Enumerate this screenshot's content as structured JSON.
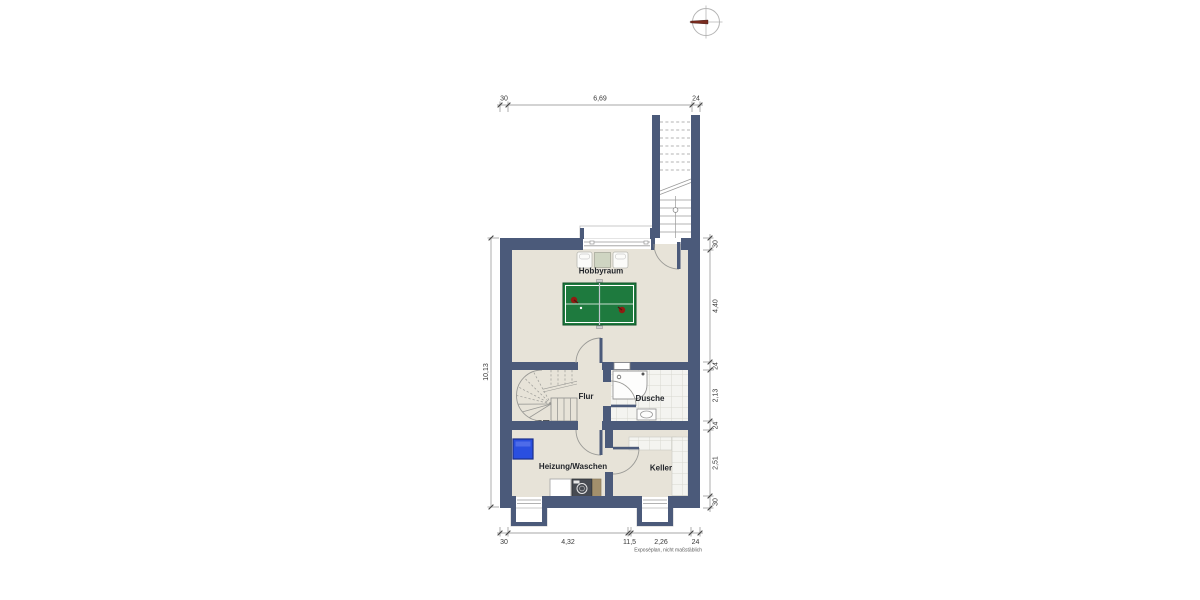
{
  "plan": {
    "title": "Kellergeschoss Grundriss",
    "rooms": {
      "hobbyraum": "Hobbyraum",
      "flur": "Flur",
      "dusche": "Dusche",
      "heizung_waschen": "Heizung/Waschen",
      "keller": "Keller"
    },
    "dimensions": {
      "top": {
        "wall_left": "30",
        "span": "6,69",
        "stair": "24"
      },
      "left": {
        "total": "10,13"
      },
      "right": {
        "wall_top": "30",
        "hobbyraum": "4,40",
        "wall_a": "24",
        "dusche": "2,13",
        "wall_b": "24",
        "keller": "2,51",
        "wall_bottom": "30"
      },
      "bottom": {
        "wall_left": "30",
        "heizung": "4,32",
        "wall_mid": "11,5",
        "keller": "2,26",
        "wall_right": "24"
      }
    },
    "disclaimer": "Exposéplan, nicht maßstäblich",
    "icons": {
      "compass": "compass-north-icon",
      "paddle": "table-tennis-paddle-icon"
    },
    "colors": {
      "wall": "#4b5a7a",
      "floor": "#e7e3d8",
      "tile": "#f4f4f0",
      "tile_line": "#d8d8d0",
      "table_green": "#1e7a3e",
      "boiler_blue": "#2a4fe0",
      "paddle_red": "#8f1d12",
      "needle_red": "#7a2b1f"
    }
  }
}
